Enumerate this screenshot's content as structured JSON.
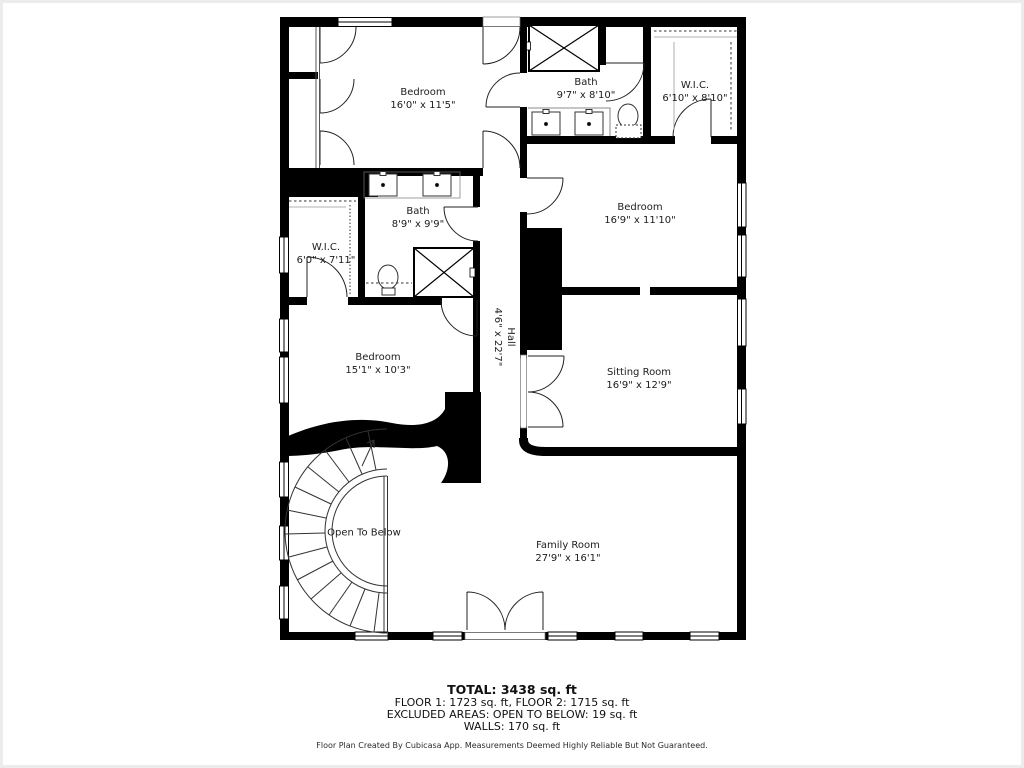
{
  "page": {
    "background": "#ffffff",
    "wall_color": "#000000",
    "text_color": "#1c1c1c"
  },
  "rooms": {
    "bedroom1": {
      "name": "Bedroom",
      "dims": "16'0\" x 11'5\""
    },
    "bath1": {
      "name": "Bath",
      "dims": "9'7\" x 8'10\""
    },
    "wic1": {
      "name": "W.I.C.",
      "dims": "6'10\" x 8'10\""
    },
    "bedroom2": {
      "name": "Bedroom",
      "dims": "16'9\" x 11'10\""
    },
    "bath2": {
      "name": "Bath",
      "dims": "8'9\" x 9'9\""
    },
    "wic2": {
      "name": "W.I.C.",
      "dims": "6'0\" x 7'11\""
    },
    "hall": {
      "name": "Hall",
      "dims": "4'6\" x 22'7\""
    },
    "bedroom3": {
      "name": "Bedroom",
      "dims": "15'1\" x 10'3\""
    },
    "sitting_room": {
      "name": "Sitting Room",
      "dims": "16'9\" x 12'9\""
    },
    "open_to_below": {
      "name": "Open To Below"
    },
    "family_room": {
      "name": "Family Room",
      "dims": "27'9\" x 16'1\""
    }
  },
  "summary": {
    "total": "TOTAL: 3438 sq. ft",
    "floors": "FLOOR 1: 1723 sq. ft, FLOOR 2: 1715 sq. ft",
    "excluded": "EXCLUDED AREAS: OPEN TO BELOW: 19 sq. ft",
    "walls": "WALLS: 170 sq. ft"
  },
  "credit": "Floor Plan Created By Cubicasa App. Measurements Deemed Highly Reliable But Not Guaranteed."
}
